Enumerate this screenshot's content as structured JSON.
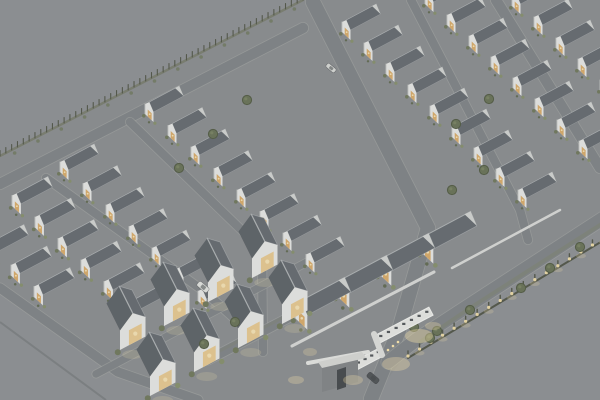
{
  "scene": {
    "width": 600,
    "height": 400,
    "description": "Aerial axonometric architectural render of a gated housing estate at dusk: diagonal rows of identical white gabled houses with dark roofs and warm lit windows, internal streets, perimeter fence, lit boundary fence, entrance gate with canopies, a few cars and trees on a uniform grey ground.",
    "colors": {
      "background": "#8c8e91",
      "site_ground": "#888a8d",
      "road": "#7d8084",
      "curb": "#a6a7a4",
      "roof_main": "#61666b",
      "roof_far": "#565a5f",
      "roof_left": "#585d62",
      "ridge": "#aeb1b3",
      "roof_edge": "rgba(205,208,209,0.4)",
      "facade": "#e9e9e6",
      "facade_shade": "#c4c5c2",
      "back_gable": "#d3d4d1",
      "window_warm": "#d9a964",
      "window_bright": "#f7e3b2",
      "cluster_window": "#e8c88e",
      "shrub_dark": "#6c7457",
      "shrub_mid": "#848d68",
      "shrub_deep": "#5d664c",
      "tree": "#646e51",
      "tree_rim": "#4d563d",
      "fence_dark": "#4c5042",
      "fence_base": "#777a6b",
      "wall_white": "#d9dad7",
      "verge": "#7b8168",
      "glow": "#ffe9ad",
      "canopy": "#e8e8e5",
      "canopy_edge": "#f6f6f3",
      "canopy_light": "#4e5154",
      "guard_wall": "#7f8184",
      "guard_top": "#d8d8d5",
      "guard_door": "#3f4246",
      "car_white": "#e3e4e1",
      "car_dark": "#4a4d50",
      "haze": "rgba(141,143,146,0.13)"
    }
  },
  "site": {
    "outline": [
      [
        0,
        158
      ],
      [
        303,
        0
      ],
      [
        600,
        0
      ],
      [
        600,
        212
      ],
      [
        470,
        302
      ],
      [
        418,
        338
      ],
      [
        372,
        400
      ],
      [
        196,
        400
      ],
      [
        118,
        370
      ],
      [
        0,
        286
      ]
    ]
  },
  "sprites": {
    "main": {
      "baseP": [
        8.5,
        8
      ],
      "wall": 10,
      "rise": 6,
      "roofQ": [
        30,
        -16
      ],
      "winH": 7
    },
    "cluster": {
      "baseQ": [
        17,
        -9
      ],
      "wall": 13,
      "rise": 7,
      "roofB": [
        -9,
        -18
      ],
      "winH": 10
    }
  },
  "roads": [
    {
      "name": "avenue-a1",
      "pts": [
        [
          0,
          184
        ],
        [
          303,
          28
        ]
      ],
      "w": 12
    },
    {
      "name": "street-s1",
      "pts": [
        [
          46,
          178
        ],
        [
          205,
          292
        ],
        [
          236,
          320
        ]
      ],
      "w": 10
    },
    {
      "name": "street-s2",
      "pts": [
        [
          130,
          122
        ],
        [
          262,
          250
        ],
        [
          263,
          352
        ]
      ],
      "w": 10
    },
    {
      "name": "street-s3-main",
      "pts": [
        [
          313,
          2
        ],
        [
          428,
          228
        ],
        [
          399,
          330
        ],
        [
          371,
          399
        ]
      ],
      "w": 16
    },
    {
      "name": "street-s4",
      "pts": [
        [
          411,
          0
        ],
        [
          520,
          210
        ],
        [
          528,
          240
        ]
      ],
      "w": 10
    },
    {
      "name": "street-s5",
      "pts": [
        [
          496,
          0
        ],
        [
          600,
          168
        ]
      ],
      "w": 12
    },
    {
      "name": "street-t1",
      "pts": [
        [
          208,
          360
        ],
        [
          452,
          232
        ]
      ],
      "w": 11
    },
    {
      "name": "perimeter-road-br",
      "pts": [
        [
          622,
          206
        ],
        [
          468,
          306
        ],
        [
          416,
          340
        ],
        [
          388,
          362
        ]
      ],
      "w": 15
    },
    {
      "name": "boundary-road-bl",
      "pts": [
        [
          0,
          288
        ],
        [
          118,
          372
        ],
        [
          198,
          400
        ]
      ],
      "w": 11
    },
    {
      "name": "cluster-road",
      "pts": [
        [
          96,
          374
        ],
        [
          326,
          252
        ]
      ],
      "w": 9
    }
  ],
  "outer_line_bl": {
    "pts": [
      [
        0,
        322
      ],
      [
        106,
        400
      ]
    ],
    "w": 2,
    "color": "#797c7f"
  },
  "verges": [
    {
      "pts": [
        [
          614,
          216
        ],
        [
          470,
          308
        ],
        [
          420,
          342
        ]
      ],
      "w": 4,
      "op": 0.45
    },
    {
      "pts": [
        [
          214,
          354
        ],
        [
          448,
          230
        ]
      ],
      "w": 3,
      "op": 0.3
    }
  ],
  "white_walls": [
    {
      "pts": [
        [
          292,
          346
        ],
        [
          434,
          272
        ]
      ],
      "w": 3
    },
    {
      "pts": [
        [
          452,
          268
        ],
        [
          560,
          210
        ]
      ],
      "w": 2.5
    }
  ],
  "rows": [
    {
      "name": "row-s5",
      "sprite": "main",
      "start": [
        512,
        6
      ],
      "step": [
        22,
        21
      ],
      "count": 5,
      "scale": 1
    },
    {
      "name": "row-s4",
      "sprite": "main",
      "start": [
        425,
        4
      ],
      "step": [
        22,
        21
      ],
      "count": 8,
      "scale": 1
    },
    {
      "name": "row-s3",
      "sprite": "main",
      "start": [
        342,
        32
      ],
      "step": [
        22,
        21
      ],
      "count": 9,
      "scale": 1
    },
    {
      "name": "row-s2",
      "sprite": "main",
      "start": [
        145,
        114
      ],
      "step": [
        23,
        21.5
      ],
      "count": 8,
      "scale": 1
    },
    {
      "name": "row-s1",
      "sprite": "main",
      "start": [
        60,
        172
      ],
      "step": [
        23,
        21.5
      ],
      "count": 7,
      "scale": 1
    },
    {
      "name": "row-s0",
      "sprite": "main",
      "start": [
        12,
        206
      ],
      "step": [
        23,
        21.5
      ],
      "count": 6,
      "scale": 1.05
    },
    {
      "name": "row-sm1",
      "sprite": "main",
      "start": [
        -12,
        254
      ],
      "step": [
        23,
        21.5
      ],
      "count": 3,
      "scale": 1.05
    },
    {
      "name": "row-t1",
      "sprite": "main",
      "start": [
        295,
        318
      ],
      "step": [
        42,
        -22
      ],
      "count": 4,
      "scale": 1.45
    },
    {
      "name": "cluster-back",
      "sprite": "cluster",
      "start": [
        120,
        350
      ],
      "step": [
        44,
        -24
      ],
      "count": 4,
      "scale": 1.5
    },
    {
      "name": "cluster-front",
      "sprite": "cluster",
      "start": [
        150,
        396
      ],
      "step": [
        44,
        -24
      ],
      "count": 4,
      "scale": 1.5
    }
  ],
  "fence_topleft": {
    "from": [
      303,
      0
    ],
    "to": [
      0,
      156
    ],
    "post_spacing": 6.5,
    "post_h": 5.5
  },
  "lit_fence_br": {
    "from": [
      604,
      240
    ],
    "to": [
      408,
      358
    ],
    "post_spacing": 13,
    "post_h": 7
  },
  "entrance": {
    "canopies": [
      {
        "start": [
          374,
          336
        ],
        "len": 62,
        "w": 9,
        "lights": 7
      },
      {
        "start": [
          345,
          366
        ],
        "len": 40,
        "w": 9,
        "lights": 5
      }
    ],
    "spine": {
      "from": [
        374,
        334
      ],
      "to": [
        382,
        355
      ],
      "w": 6
    },
    "guard_house": {
      "front": [
        [
          322,
          366
        ],
        [
          358,
          356
        ],
        [
          358,
          382
        ],
        [
          322,
          392
        ]
      ],
      "top": [
        [
          318,
          362
        ],
        [
          362,
          352
        ],
        [
          366,
          358
        ],
        [
          322,
          368
        ]
      ],
      "door": [
        [
          337,
          370
        ],
        [
          346,
          367
        ],
        [
          346,
          387
        ],
        [
          337,
          390
        ]
      ],
      "slab": {
        "from": [
          308,
          363
        ],
        "to": [
          368,
          352
        ],
        "w": 4
      }
    },
    "glows": [
      [
        396,
        364,
        14,
        7,
        0.35
      ],
      [
        419,
        336,
        14,
        7,
        0.4
      ],
      [
        353,
        380,
        10,
        5,
        0.3
      ],
      [
        296,
        380,
        8,
        4,
        0.3
      ],
      [
        433,
        326,
        8,
        4,
        0.3
      ],
      [
        310,
        352,
        7,
        4,
        0.25
      ]
    ],
    "bollards": [
      [
        388,
        350
      ],
      [
        393,
        346
      ],
      [
        398,
        342
      ]
    ]
  },
  "trees": [
    [
      247,
      100
    ],
    [
      213,
      134
    ],
    [
      179,
      168
    ],
    [
      456,
      124
    ],
    [
      489,
      99
    ],
    [
      521,
      288
    ],
    [
      550,
      268
    ],
    [
      580,
      247
    ],
    [
      470,
      310
    ],
    [
      437,
      331
    ],
    [
      452,
      190
    ],
    [
      484,
      170
    ],
    [
      414,
      327
    ],
    [
      430,
      338
    ],
    [
      235,
      322
    ],
    [
      204,
      344
    ]
  ],
  "cars": [
    {
      "pos": [
        203,
        287
      ],
      "angle": 40,
      "len": 13,
      "wid": 6,
      "color": "#e3e4e1"
    },
    {
      "pos": [
        373,
        378
      ],
      "angle": 40,
      "len": 13,
      "wid": 6,
      "color": "#4a4d50"
    },
    {
      "pos": [
        331,
        68
      ],
      "angle": 40,
      "len": 11,
      "wid": 5,
      "color": "#d8d9d6"
    }
  ]
}
